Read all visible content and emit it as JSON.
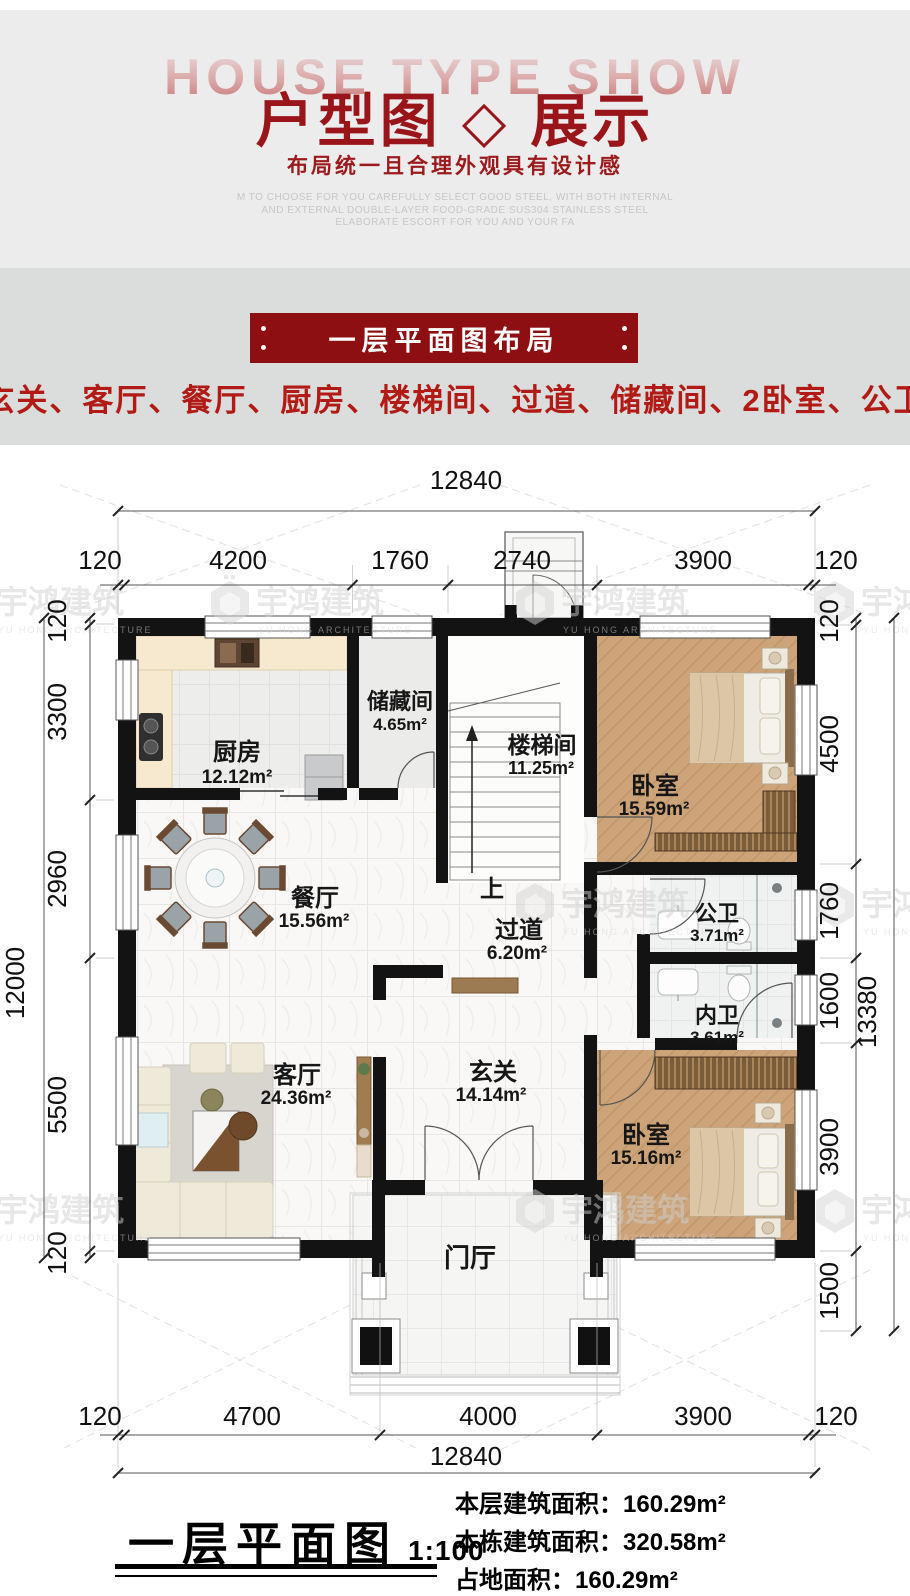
{
  "header": {
    "bg_title": "HOUSE TYPE SHOW",
    "title": "户型图 ◇ 展示",
    "subtitle": "布局统一且合理外观具有设计感",
    "desc_line1": "M TO CHOOSE FOR YOU CAREFULLY SELECT GOOD STEEL, WITH BOTH INTERNAL",
    "desc_line2": "AND EXTERNAL DOUBLE-LAYER FOOD-GRADE SUS304 STAINLESS STEEL",
    "desc_line3": "ELABORATE ESCORT FOR YOU AND YOUR FA"
  },
  "section": {
    "banner": "一层平面图布局",
    "room_list": "门厅、玄关、客厅、餐厅、厨房、楼梯间、过道、储藏间、2卧室、公卫、内卫"
  },
  "plan": {
    "rooms": [
      {
        "name": "厨房",
        "area": "12.12m²"
      },
      {
        "name": "储藏间",
        "area": "4.65m²"
      },
      {
        "name": "楼梯间",
        "area": "11.25m²"
      },
      {
        "name": "卧室",
        "area": "15.59m²"
      },
      {
        "name": "餐厅",
        "area": "15.56m²"
      },
      {
        "name": "过道",
        "area": "6.20m²"
      },
      {
        "name": "公卫",
        "area": "3.71m²"
      },
      {
        "name": "内卫",
        "area": "3.61m²"
      },
      {
        "name": "客厅",
        "area": "24.36m²"
      },
      {
        "name": "玄关",
        "area": "14.14m²"
      },
      {
        "name": "卧室",
        "area": "15.16m²"
      },
      {
        "name": "门厅",
        "area": ""
      }
    ],
    "stair_up": "上",
    "dims": {
      "top_overall": "12840",
      "top": [
        "120",
        "4200",
        "1760",
        "2740",
        "3900",
        "120"
      ],
      "bottom": [
        "120",
        "4700",
        "4000",
        "3900",
        "120"
      ],
      "bottom_overall": "12840",
      "left": [
        "120",
        "3300",
        "2960",
        "5500",
        "120"
      ],
      "left_overall": "12000",
      "right": [
        "120",
        "4500",
        "1760",
        "1600",
        "3900",
        "1500"
      ],
      "right_overall": "13380"
    },
    "watermark": {
      "cn": "宇鸿建筑",
      "en": "YU HONG ARCHITECTURE"
    }
  },
  "footer": {
    "plan_name": "一层平面图",
    "scale": "1:100",
    "stat1": "本层建筑面积：160.29m²",
    "stat2": "本栋建筑面积：320.58m²",
    "stat3": "占地面积：160.29m²"
  },
  "colors": {
    "accent_red": "#99151a",
    "banner_red": "#8d0f12",
    "list_red": "#b21a15"
  }
}
